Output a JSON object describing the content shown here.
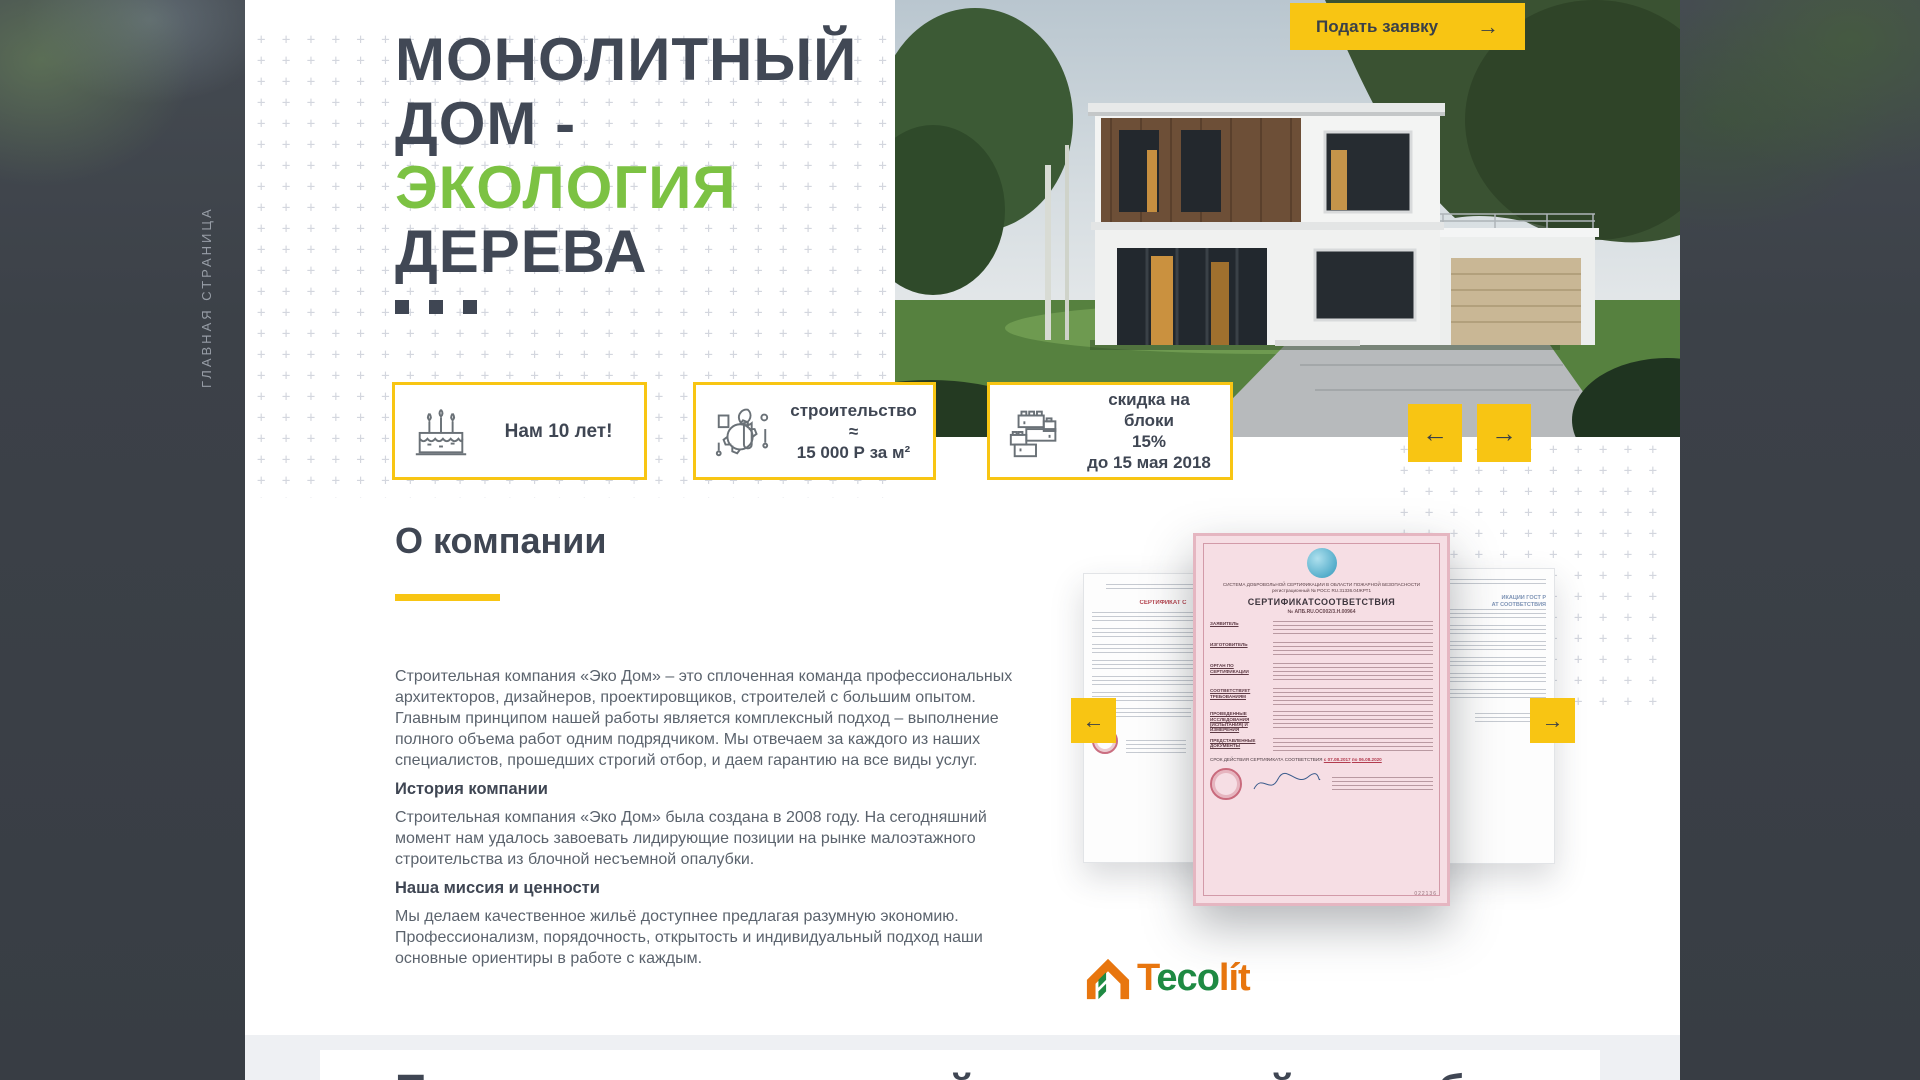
{
  "colors": {
    "accent_yellow": "#F8C513",
    "title_dark": "#3F4653",
    "eco_green": "#7CC243"
  },
  "side_nav": {
    "vertical_label": "ГЛАВНАЯ СТРАНИЦА"
  },
  "hero": {
    "apply_button_label": "Подать заявку",
    "apply_button_arrow": "→",
    "title_line1": "МОНОЛИТНЫЙ",
    "title_line2": "ДОМ -",
    "title_line3": "ЭКОЛОГИЯ",
    "title_line4": "ДЕРЕВА",
    "prev_arrow": "←",
    "next_arrow": "→"
  },
  "badges": [
    {
      "text": "Нам 10 лет!"
    },
    {
      "line1": "строительство ≈",
      "line2": "15 000 Р за м²"
    },
    {
      "line1": "скидка на блоки",
      "line2": "15%",
      "line3": "до 15 мая 2018"
    }
  ],
  "about": {
    "heading": "О компании",
    "paragraph1": "Строительная компания «Эко Дом» – это сплоченная команда профессиональных архитекторов, дизайнеров, проектировщиков, строителей с большим опытом. Главным принципом нашей работы является комплексный подход – выполнение полного объема работ одним подрядчиком. Мы отвечаем за каждого из наших специалистов, прошедших строгий отбор, и даем гарантию на все виды услуг.",
    "subheading1": "История компании",
    "paragraph2": "Строительная компания «Эко Дом» была создана в 2008 году. На сегодняшний момент нам удалось завоевать лидирующие позиции на рынке малоэтажного строительства из блочной несъемной опалубки.",
    "subheading2": "Наша миссия и ценности",
    "paragraph3": "Мы делаем качественное жильё доступнее предлагая разумную экономию. Профессионализм, порядочность, открытость и индивидуальный подход наши основные ориентиры в работе с каждым."
  },
  "certificates": {
    "prev_arrow": "←",
    "next_arrow": "→",
    "center": {
      "header_line1": "СИСТЕМА ДОБРОВОЛЬНОЙ СЕРТИФИКАЦИИ В ОБЛАСТИ ПОЖАРНОЙ БЕЗОПАСНОСТИ",
      "header_line2": "регистрационный № РОСС RU.31336.04ЖРТ1",
      "title": "СЕРТИФИКАТСООТВЕТСТВИЯ",
      "number": "№ АПБ.RU.ОС002/3.Н.00964",
      "labels": [
        "ЗАЯВИТЕЛЬ",
        "ИЗГОТОВИТЕЛЬ",
        "ОРГАН ПО СЕРТИФИКАЦИИ",
        "СООТВЕТСТВУЕТ ТРЕБОВАНИЯМ",
        "ПРОВЕДЕННЫЕ ИССЛЕДОВАНИЯ (ИСПЫТАНИЯ) И ИЗМЕРЕНИЯ",
        "ПРЕДСТАВЛЕННЫЕ ДОКУМЕНТЫ"
      ],
      "validity_label": "СРОК ДЕЙСТВИЯ СЕРТИФИКАТА СООТВЕТСТВИЯ",
      "validity_from": "с 07.08.2017",
      "validity_to": "по 06.08.2020",
      "serial": "022136"
    },
    "left": {
      "title": "СЕРТИФИКАТ С"
    },
    "right": {
      "title_line1": "ИКАЦИИ ГОСТ Р",
      "title_line2": "АТ СООТВЕТСТВИЯ"
    }
  },
  "brand": {
    "part1": "T",
    "part2": "ec",
    "part3": "o",
    "part4": "lít"
  },
  "next_section": {
    "heading": "Преимущества несъемной строительной опалубки"
  }
}
